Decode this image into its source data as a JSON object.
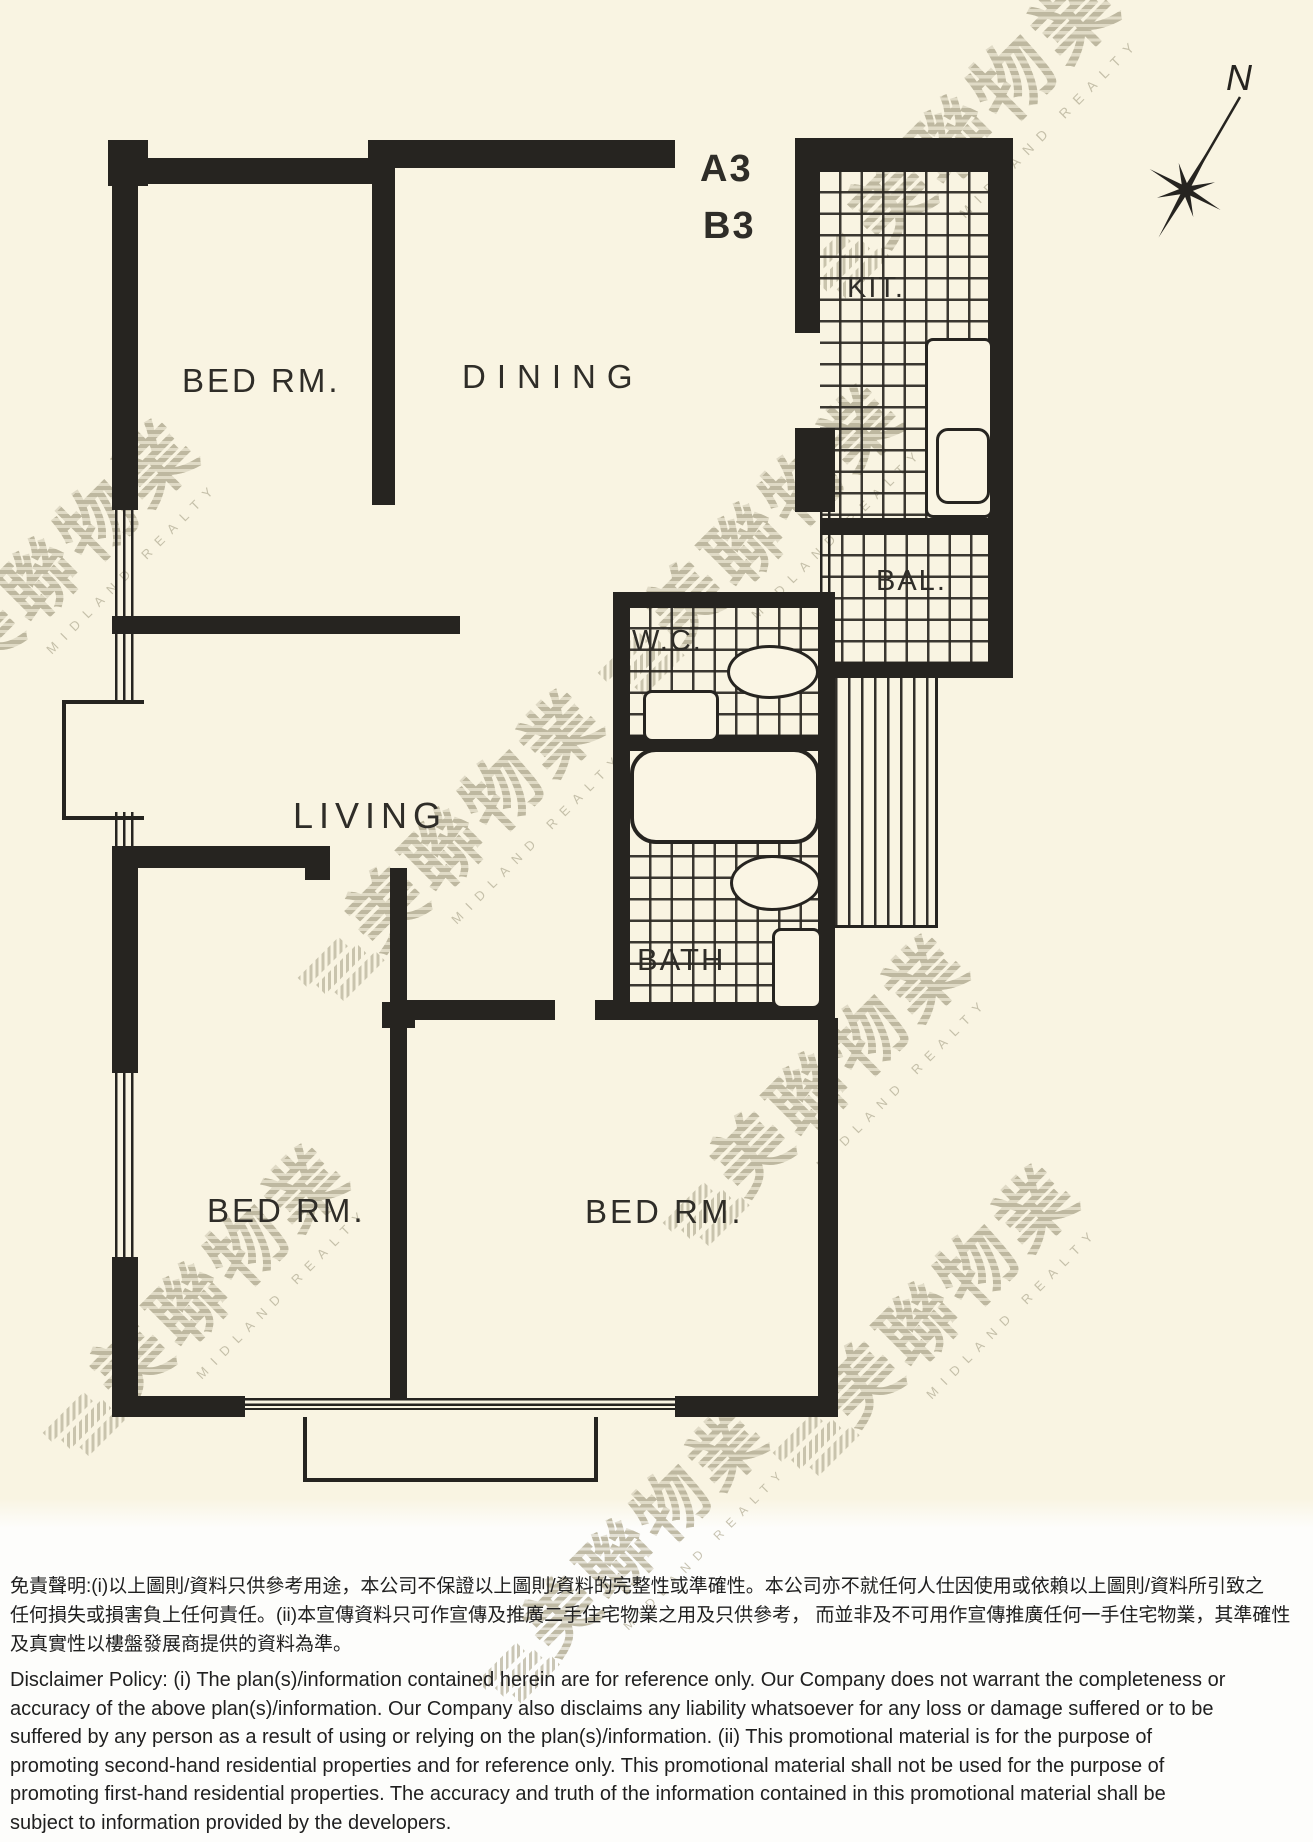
{
  "plan": {
    "unit_labels": [
      "A3",
      "B3"
    ],
    "rooms": [
      {
        "id": "bedroom-top",
        "label": "BED RM."
      },
      {
        "id": "dining",
        "label": "DINING"
      },
      {
        "id": "kitchen",
        "label": "KIT."
      },
      {
        "id": "balcony",
        "label": "BAL."
      },
      {
        "id": "wc",
        "label": "W.C."
      },
      {
        "id": "living",
        "label": "LIVING"
      },
      {
        "id": "bath",
        "label": "BATH"
      },
      {
        "id": "bedroom-bottom-left",
        "label": "BED RM."
      },
      {
        "id": "bedroom-bottom-right",
        "label": "BED RM."
      }
    ],
    "compass": {
      "label": "N"
    }
  },
  "watermark": {
    "cjk": "美聯物業",
    "latin": "MIDLAND REALTY"
  },
  "disclaimer": {
    "zh_lines": [
      "免責聲明:(i)以上圖則/資料只供參考用途，本公司不保證以上圖則/資料的完整性或準確性。本公司亦不就任何人仕因使用或依賴以上圖則/資料所引致之",
      "任何損失或損害負上任何責任。(ii)本宣傳資料只可作宣傳及推廣二手住宅物業之用及只供參考， 而並非及不可用作宣傳推廣任何一手住宅物業，其準確性",
      "及真實性以樓盤發展商提供的資料為準。"
    ],
    "en_lines": [
      "Disclaimer Policy: (i) The plan(s)/information contained herein are for reference only. Our Company does not warrant the completeness or",
      "accuracy of the above plan(s)/information. Our Company also disclaims any liability whatsoever for any loss or damage suffered or to be",
      "suffered by any person as a result of using or relying on the plan(s)/information. (ii) This promotional material is for the purpose of",
      "promoting second-hand residential properties and for reference only. This promotional material shall not be used for the purpose of",
      "promoting first-hand residential properties. The accuracy and truth of the information contained in this promotional material shall be",
      "subject to information provided by the developers."
    ]
  },
  "colors": {
    "paper": "#f9f4e2",
    "ink": "#262420",
    "watermark": "#b7b199",
    "footer_background": "#fdfdfb"
  }
}
